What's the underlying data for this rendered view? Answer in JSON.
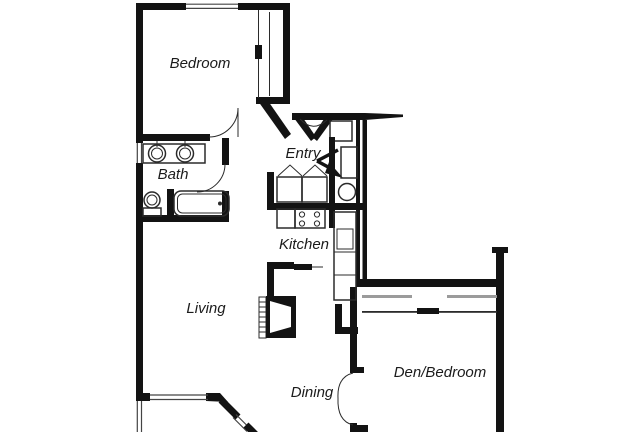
{
  "title": "Apartment floor plan",
  "colors": {
    "wall": "#131313",
    "line": "#2b2b2b",
    "track": "#9b9b9b",
    "background": "#ffffff",
    "text": "#1b1b1b"
  },
  "rooms": [
    {
      "name": "bedroom",
      "label": "Bedroom"
    },
    {
      "name": "bath",
      "label": "Bath"
    },
    {
      "name": "entry",
      "label": "Entry"
    },
    {
      "name": "kitchen",
      "label": "Kitchen"
    },
    {
      "name": "living",
      "label": "Living"
    },
    {
      "name": "dining",
      "label": "Dining"
    },
    {
      "name": "den_bedroom",
      "label": "Den/Bedroom"
    }
  ],
  "fixtures": [
    "bedroom-closet-sliding-door",
    "front-entry-door",
    "entry-direction-arrow",
    "coat-closet",
    "laundry-bifold-doors",
    "washer-dryer",
    "utility-cabinet",
    "water-heater",
    "range-stove",
    "kitchen-sink-counter",
    "pass-through-counter",
    "fireplace",
    "vanity-double-sinks",
    "toilet",
    "bathtub",
    "bath-door",
    "bedroom-door",
    "den-closet-sliding-doors",
    "den-double-doors",
    "bay-window",
    "bedroom-window",
    "bath-window",
    "deck-edge"
  ]
}
